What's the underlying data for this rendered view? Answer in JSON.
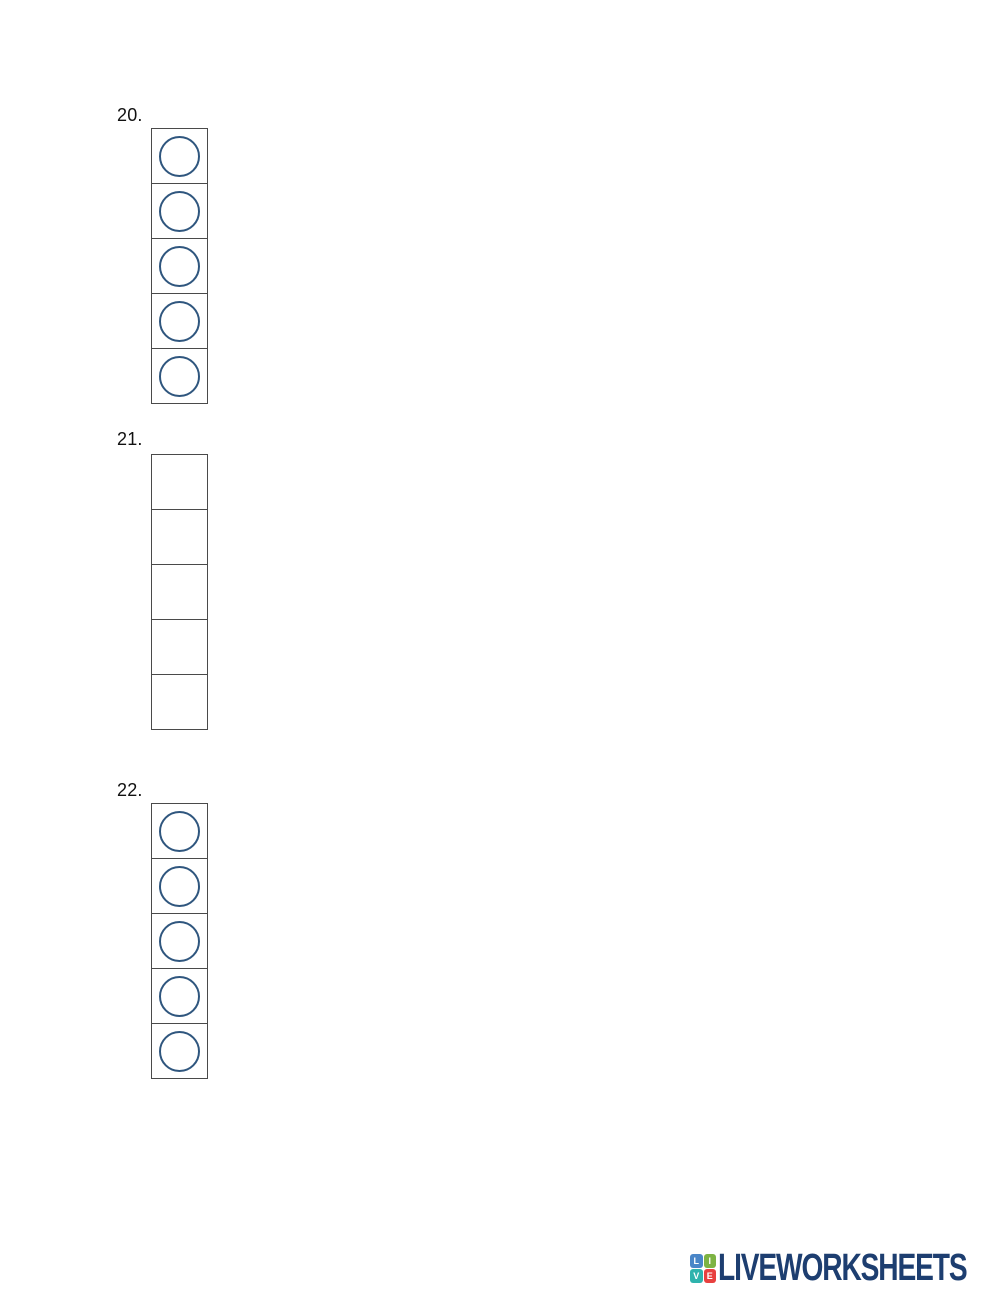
{
  "questions": [
    {
      "number": "20.",
      "type": "choice",
      "cell_count": 5
    },
    {
      "number": "21.",
      "type": "text",
      "cell_count": 5
    },
    {
      "number": "22.",
      "type": "choice",
      "cell_count": 5
    }
  ],
  "logo": {
    "wordmark": "LIVEWORKSHEETS",
    "wordmark_color": "#1d3e70",
    "blocks": [
      {
        "letter": "L",
        "color": "#4a86c8"
      },
      {
        "letter": "I",
        "color": "#7db343"
      },
      {
        "letter": "V",
        "color": "#2fb3ad"
      },
      {
        "letter": "E",
        "color": "#e8403f"
      }
    ]
  },
  "colors": {
    "page_background": "#ffffff",
    "cell_border": "#4a4a4a",
    "choice_circle_stroke": "#2f567e",
    "question_label": "#111111"
  }
}
